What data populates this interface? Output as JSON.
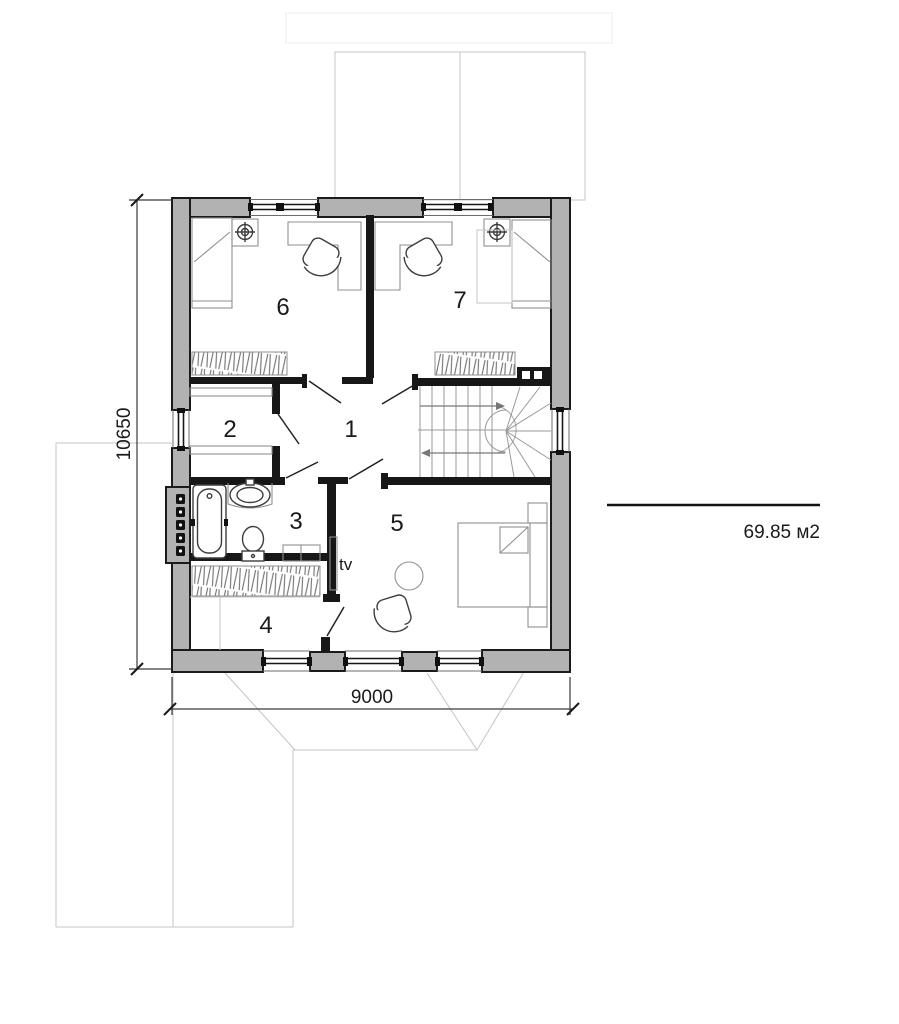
{
  "plan": {
    "room_numbers": {
      "r1": "1",
      "r2": "2",
      "r3": "3",
      "r4": "4",
      "r5": "5",
      "r6": "6",
      "r7": "7"
    },
    "labels": {
      "tv": "tv",
      "area": "69.85 м2"
    },
    "dimensions": {
      "vertical": "10650",
      "horizontal": "9000"
    },
    "colors": {
      "wall_fill": "#b2b2b2",
      "wall_outline": "#1b1b1b",
      "interior_wall": "#171717",
      "underlay_line": "#c4c4c4",
      "furniture_line": "#8f8f8f",
      "background": "#ffffff"
    }
  }
}
